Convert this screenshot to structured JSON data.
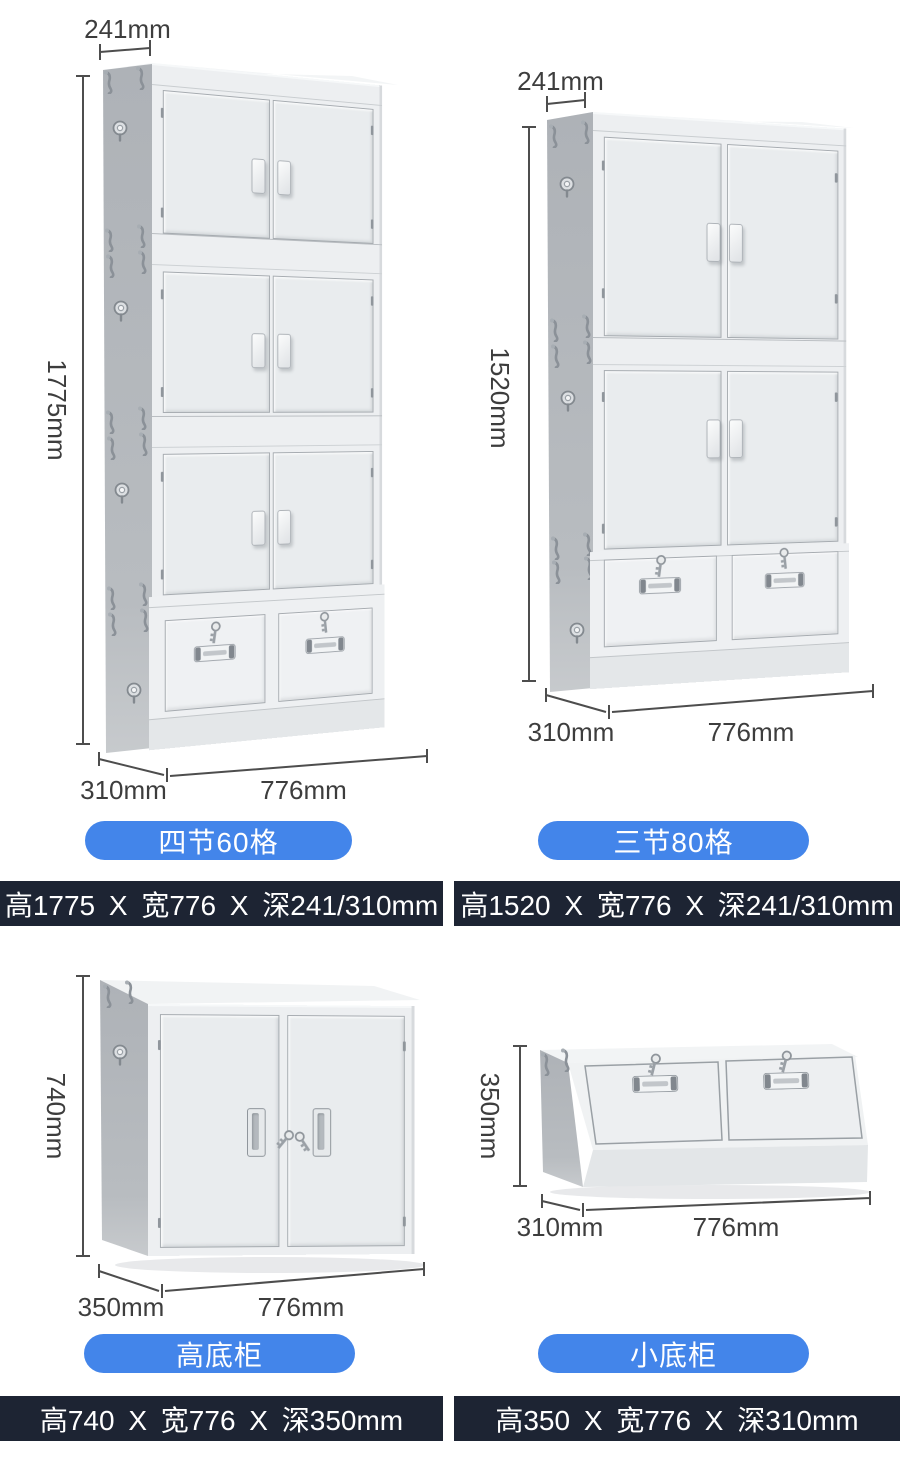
{
  "page": {
    "background": "#ffffff",
    "accent": "#4385ea",
    "bar_bg": "#1d2433"
  },
  "products": [
    {
      "badge": "四节60格",
      "spec": "高1775 X 宽776 X 深241/310mm",
      "dims": {
        "top_depth": "241mm",
        "height": "1775mm",
        "bottom_depth": "310mm",
        "width": "776mm"
      }
    },
    {
      "badge": "三节80格",
      "spec": "高1520 X 宽776 X 深241/310mm",
      "dims": {
        "top_depth": "241mm",
        "height": "1520mm",
        "bottom_depth": "310mm",
        "width": "776mm"
      }
    },
    {
      "badge": "高底柜",
      "spec": "高740 X 宽776 X 深350mm",
      "dims": {
        "height": "740mm",
        "bottom_depth": "350mm",
        "width": "776mm"
      }
    },
    {
      "badge": "小底柜",
      "spec": "高350 X 宽776 X 深310mm",
      "dims": {
        "height": "350mm",
        "bottom_depth": "310mm",
        "width": "776mm"
      }
    }
  ]
}
